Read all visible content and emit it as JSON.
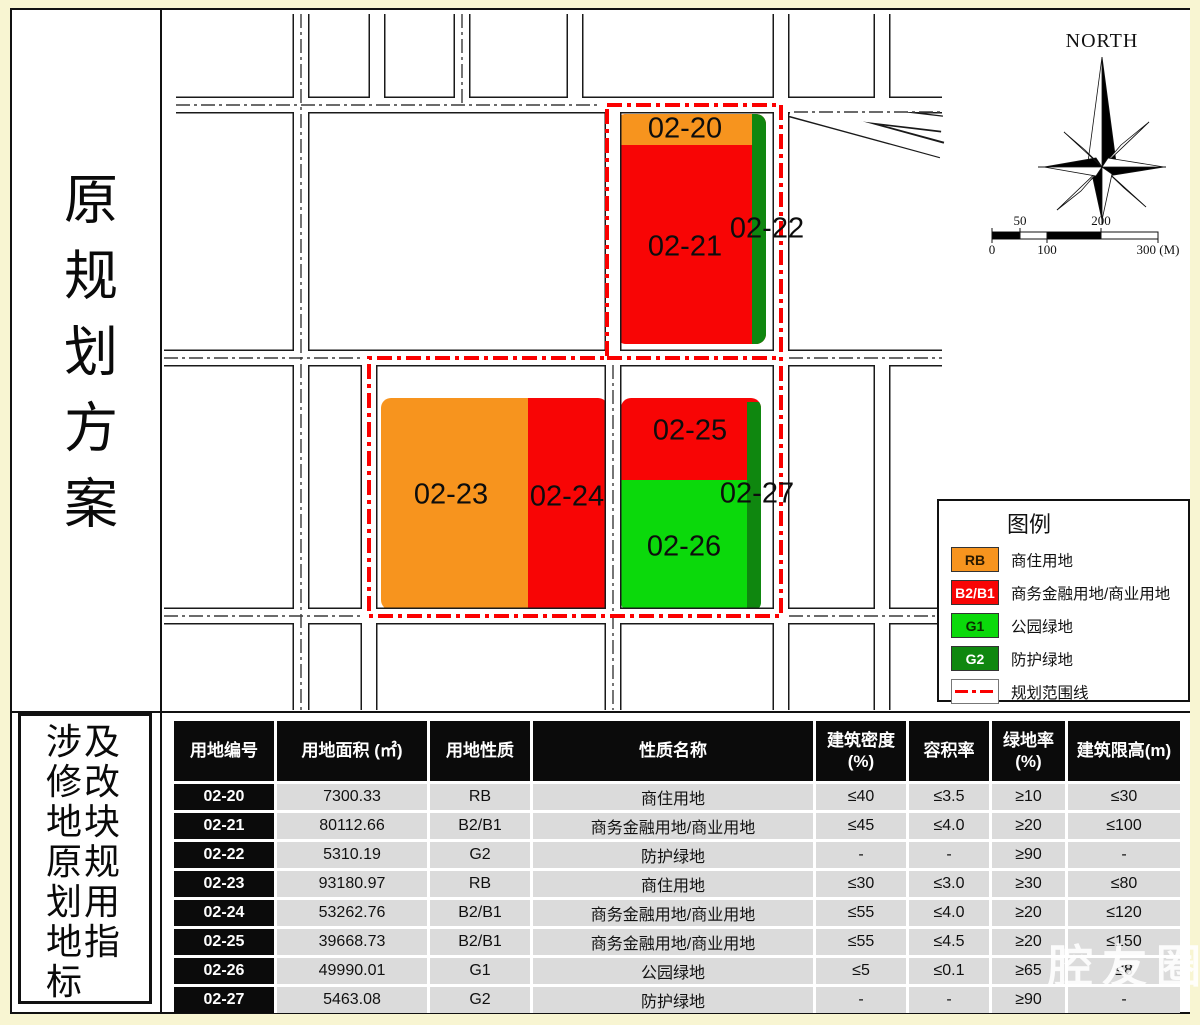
{
  "titles": {
    "left_top": "原规划方案",
    "left_bottom": "涉及修改地块原规划用地指标"
  },
  "colors": {
    "RB": "#F7941E",
    "B2B1": "#F80505",
    "G1": "#0BD90B",
    "G2": "#0F870F",
    "boundary": "#FB0000",
    "road_casing": "#1a1a1a",
    "road_fill": "#ffffff"
  },
  "map": {
    "north_label": "NORTH",
    "scale_marks": [
      {
        "text": "50",
        "x": 856,
        "row": "top"
      },
      {
        "text": "200",
        "x": 937,
        "row": "top"
      },
      {
        "text": "0",
        "x": 828,
        "row": "bottom"
      },
      {
        "text": "100",
        "x": 883,
        "row": "bottom"
      },
      {
        "text": "300 (M)",
        "x": 994,
        "row": "bottom"
      }
    ],
    "parcels": [
      {
        "id": "02-20",
        "use": "RB",
        "x": 521,
        "y": 119
      },
      {
        "id": "02-21",
        "use": "B2B1",
        "x": 521,
        "y": 237
      },
      {
        "id": "02-22",
        "use": "G2",
        "x": 603,
        "y": 219
      },
      {
        "id": "02-23",
        "use": "RB",
        "x": 287,
        "y": 485
      },
      {
        "id": "02-24",
        "use": "B2B1",
        "x": 403,
        "y": 487
      },
      {
        "id": "02-25",
        "use": "B2B1",
        "x": 526,
        "y": 421
      },
      {
        "id": "02-26",
        "use": "G1",
        "x": 520,
        "y": 537
      },
      {
        "id": "02-27",
        "use": "G2",
        "x": 593,
        "y": 484
      }
    ]
  },
  "legend": {
    "title": "图例",
    "items": [
      {
        "code": "RB",
        "label": "商住用地",
        "swatch": "#F7941E",
        "text_color": "#2b1a00"
      },
      {
        "code": "B2/B1",
        "label": "商务金融用地/商业用地",
        "swatch": "#F80505",
        "text_color": "#ffffff"
      },
      {
        "code": "G1",
        "label": "公园绿地",
        "swatch": "#0BD90B",
        "text_color": "#0b2b00"
      },
      {
        "code": "G2",
        "label": "防护绿地",
        "swatch": "#0F870F",
        "text_color": "#ffffff"
      }
    ],
    "boundary_item": {
      "label": "规划范围线"
    }
  },
  "table": {
    "headers": [
      "用地编号",
      "用地面积 (㎡)",
      "用地性质",
      "性质名称",
      "建筑密度\n(%)",
      "容积率",
      "绿地率\n(%)",
      "建筑限高(m)"
    ],
    "rows": [
      [
        "02-20",
        "7300.33",
        "RB",
        "商住用地",
        "≤40",
        "≤3.5",
        "≥10",
        "≤30"
      ],
      [
        "02-21",
        "80112.66",
        "B2/B1",
        "商务金融用地/商业用地",
        "≤45",
        "≤4.0",
        "≥20",
        "≤100"
      ],
      [
        "02-22",
        "5310.19",
        "G2",
        "防护绿地",
        "-",
        "-",
        "≥90",
        "-"
      ],
      [
        "02-23",
        "93180.97",
        "RB",
        "商住用地",
        "≤30",
        "≤3.0",
        "≥30",
        "≤80"
      ],
      [
        "02-24",
        "53262.76",
        "B2/B1",
        "商务金融用地/商业用地",
        "≤55",
        "≤4.0",
        "≥20",
        "≤120"
      ],
      [
        "02-25",
        "39668.73",
        "B2/B1",
        "商务金融用地/商业用地",
        "≤55",
        "≤4.5",
        "≥20",
        "≤150"
      ],
      [
        "02-26",
        "49990.01",
        "G1",
        "公园绿地",
        "≤5",
        "≤0.1",
        "≥65",
        "≤8"
      ],
      [
        "02-27",
        "5463.08",
        "G2",
        "防护绿地",
        "-",
        "-",
        "≥90",
        "-"
      ]
    ]
  },
  "watermark": "腔友圈"
}
